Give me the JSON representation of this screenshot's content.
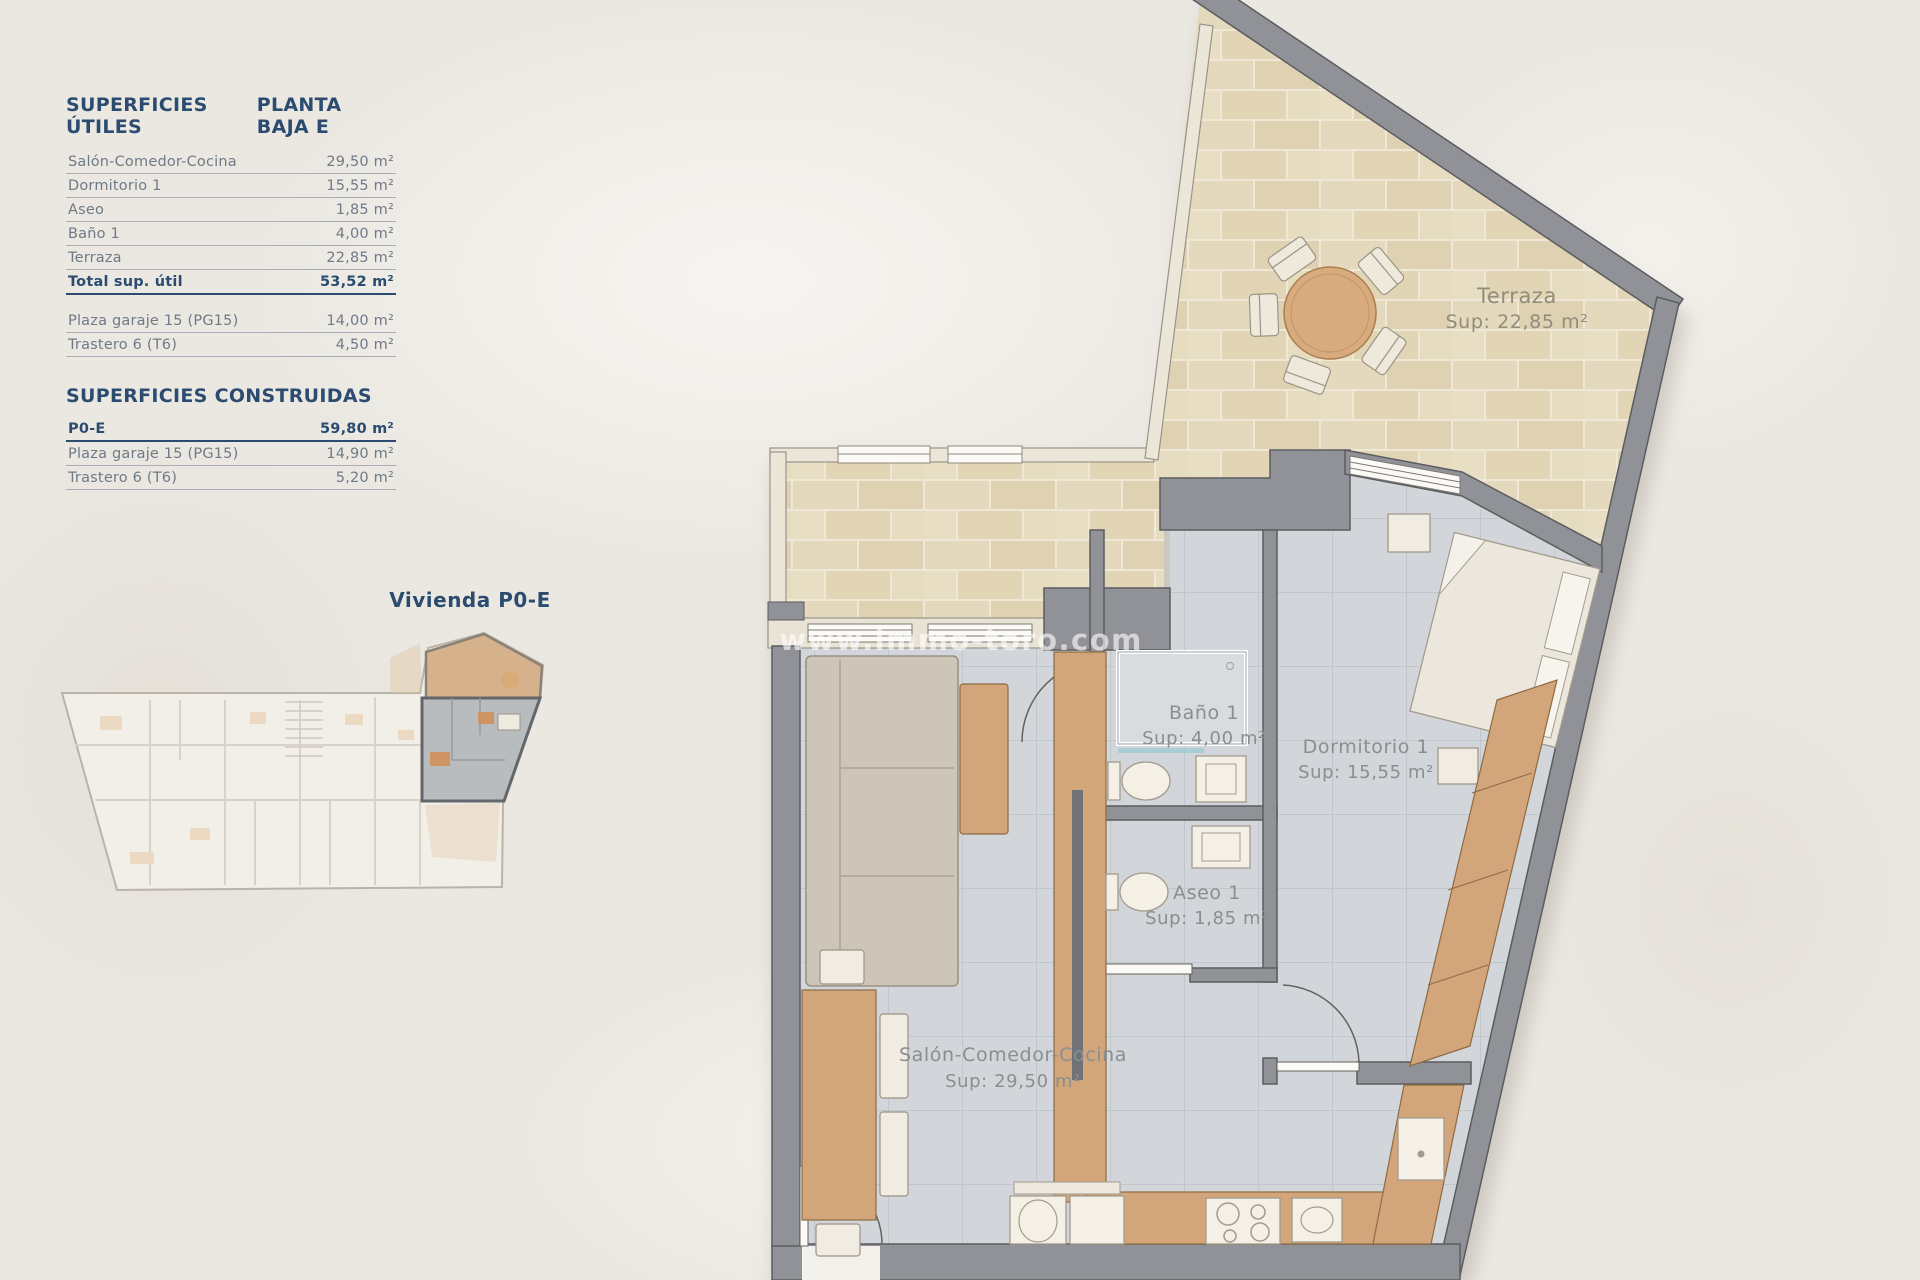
{
  "panel": {
    "useful": {
      "title": "SUPERFICIES ÚTILES",
      "plan": "PLANTA BAJA E",
      "rows": [
        {
          "label": "Salón-Comedor-Cocina",
          "value": "29,50 m²"
        },
        {
          "label": "Dormitorio 1",
          "value": "15,55 m²"
        },
        {
          "label": "Aseo",
          "value": "1,85 m²"
        },
        {
          "label": "Baño 1",
          "value": "4,00 m²"
        },
        {
          "label": "Terraza",
          "value": "22,85 m²"
        }
      ],
      "total": {
        "label": "Total sup. útil",
        "value": "53,52 m²"
      },
      "annex": [
        {
          "label": "Plaza garaje 15 (PG15)",
          "value": "14,00 m²"
        },
        {
          "label": "Trastero 6 (T6)",
          "value": "4,50 m²"
        }
      ]
    },
    "built": {
      "title": "SUPERFICIES CONSTRUIDAS",
      "rows": [
        {
          "label": "P0-E",
          "value": "59,80 m²"
        },
        {
          "label": "Plaza garaje 15 (PG15)",
          "value": "14,90 m²"
        },
        {
          "label": "Trastero 6 (T6)",
          "value": "5,20 m²"
        }
      ]
    }
  },
  "unit_label": "Vivienda P0-E",
  "watermark": "www.immo-toro.com",
  "rooms": {
    "terraza": {
      "name": "Terraza",
      "sup": "Sup: 22,85 m²"
    },
    "bano": {
      "name": "Baño 1",
      "sup": "Sup: 4,00 m²"
    },
    "dormitorio": {
      "name": "Dormitorio 1",
      "sup": "Sup: 15,55 m²"
    },
    "aseo": {
      "name": "Aseo 1",
      "sup": "Sup: 1,85 m²"
    },
    "salon": {
      "name": "Salón-Comedor-Cocina",
      "sup": "Sup: 29,50 m²"
    }
  }
}
